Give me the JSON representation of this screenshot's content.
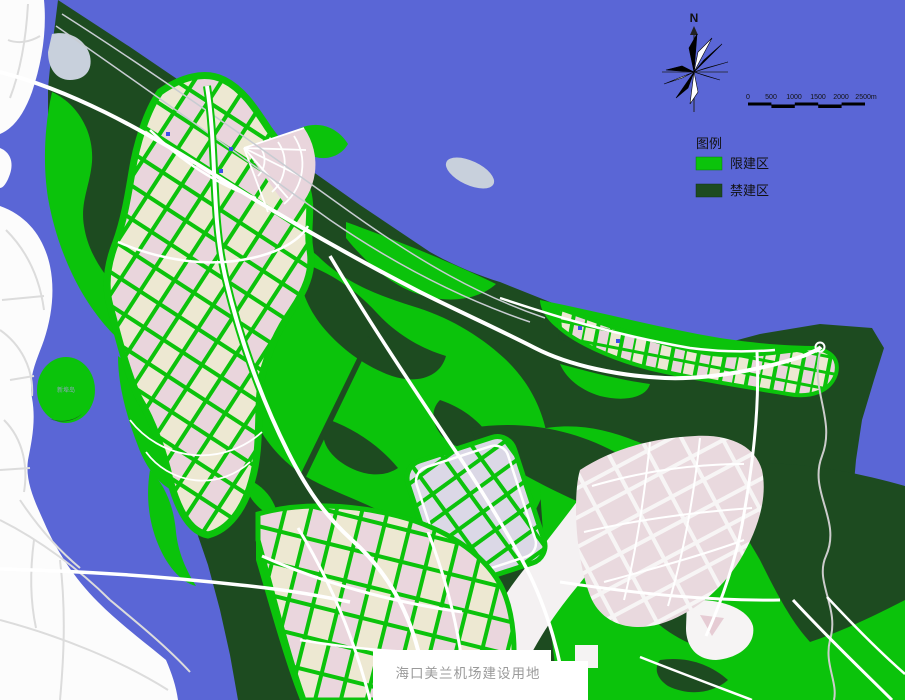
{
  "map_title": {
    "text": "海口美兰机场建设用地"
  },
  "compass": {
    "north_label": "N"
  },
  "scale_bar": {
    "ticks": [
      "0",
      "500",
      "1000",
      "1500",
      "2000",
      "2500m"
    ]
  },
  "legend": {
    "title": "图例",
    "items": [
      {
        "label": "限建区",
        "color": "#0BC30B"
      },
      {
        "label": "禁建区",
        "color": "#1D4B20"
      }
    ]
  },
  "labels": {
    "island": "新埠岛"
  },
  "colors": {
    "sea": "#5A66D6",
    "restricted_green": "#0BC30B",
    "prohibited_green": "#1D4B20",
    "urban_cream": "#EDE8D2",
    "urban_pink": "#E9D5DC",
    "road_white": "#FFFFFF"
  }
}
